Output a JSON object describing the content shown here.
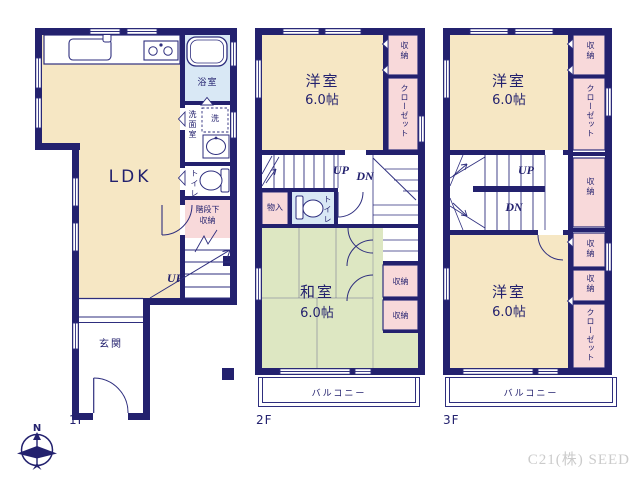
{
  "watermark": "C21(株) SEED",
  "compass": {
    "north": "N"
  },
  "colors": {
    "wall": "#23216e",
    "line": "#2e2e7e",
    "room_cream": "#f6e7c4",
    "tatami_green": "#dde7c2",
    "closet_pink": "#f8d9da",
    "bath_blue": "#d9e8f5",
    "watermark_gray": "#cbcbcb"
  },
  "floor1": {
    "label": "1F",
    "ldk": "LDK",
    "bath": "浴室",
    "washroom": "洗面室",
    "washer": "洗",
    "toilet": "トイレ",
    "under_stair_storage_line1": "階段下",
    "under_stair_storage_line2": "収納",
    "up": "UP",
    "entrance": "玄関"
  },
  "floor2": {
    "label": "2F",
    "western_room": "洋室",
    "western_room_size": "6.0帖",
    "storage_top": "収納",
    "closet": "クローゼット",
    "up": "UP",
    "down": "DN",
    "small_storage": "物入",
    "toilet": "トイレ",
    "tatami_room": "和室",
    "tatami_room_size": "6.0帖",
    "storage_mid": "収納",
    "storage_low": "収納",
    "balcony": "バルコニー"
  },
  "floor3": {
    "label": "3F",
    "western_room_top": "洋室",
    "western_room_top_size": "6.0帖",
    "storage_top": "収納",
    "closet_top": "クローゼット",
    "up": "UP",
    "down": "DN",
    "storage_stair": "収納",
    "western_room_bottom": "洋室",
    "western_room_bottom_size": "6.0帖",
    "storage_bottom1": "収納",
    "storage_bottom2": "収納",
    "closet_bottom": "クローゼット",
    "balcony": "バルコニー"
  }
}
